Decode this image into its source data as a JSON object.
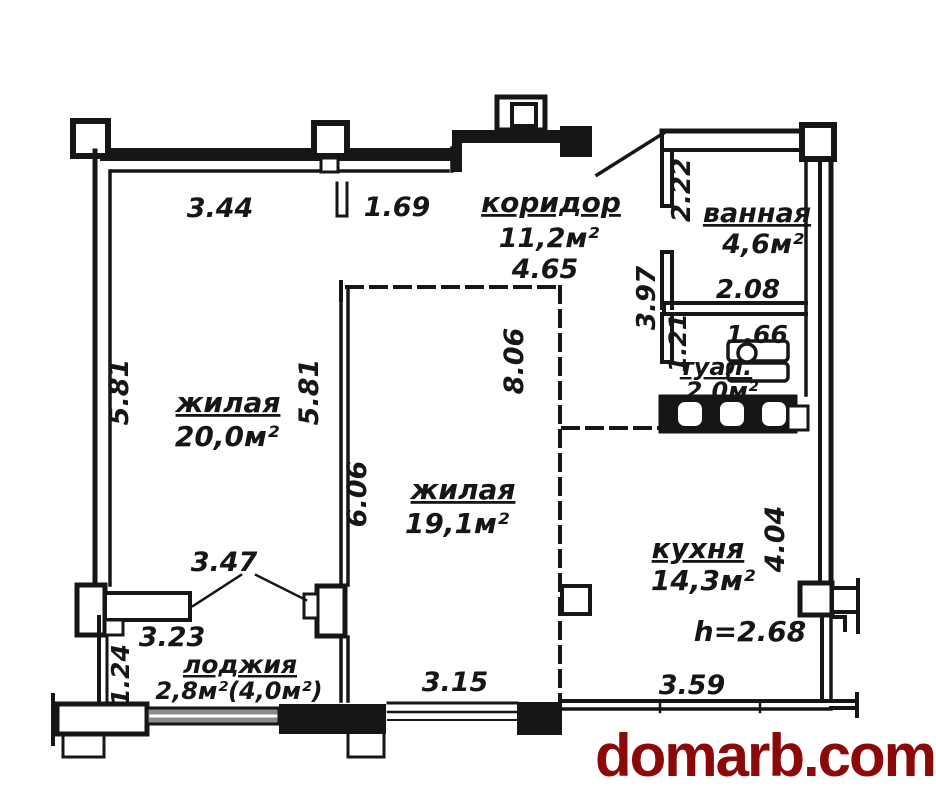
{
  "colors": {
    "ink": "#161616",
    "watermark": "#8b0909",
    "window_glass": "#8c8c8c",
    "background": "#ffffff"
  },
  "watermark": {
    "text": "domarb.com"
  },
  "rooms": {
    "corridor": {
      "label": "коридор",
      "area": "11,2м²"
    },
    "bathroom": {
      "label": "ванная",
      "area": "4,6м²"
    },
    "toilet": {
      "label": "туал.",
      "area": "2,0м²"
    },
    "living_large": {
      "label": "жилая",
      "area": "20,0м²"
    },
    "living_mid": {
      "label": "жилая",
      "area": "19,1м²"
    },
    "kitchen": {
      "label": "кухня",
      "area": "14,3м²"
    },
    "loggia": {
      "label": "лоджия",
      "area": "2,8м²(4,0м²)"
    }
  },
  "dimensions": {
    "top_wall_left": "3.44",
    "top_wall_right": "1.69",
    "corridor_length": "4.65",
    "bathroom_entry_side": "2.22",
    "bathroom_width": "2.08",
    "corridor_right_side": "3.97",
    "toilet_width": "1.66",
    "toilet_side": "1.21",
    "living_large_left": "5.81",
    "living_large_right": "5.81",
    "living_mid_right": "8.06",
    "living_mid_left": "6.06",
    "living_mid_bottom": "3.15",
    "kitchen_side": "4.04",
    "kitchen_bottom": "3.59",
    "ceiling_height": "h=2.68",
    "balcony_opening": "3.47",
    "loggia_width": "3.23",
    "loggia_depth": "1.24"
  }
}
